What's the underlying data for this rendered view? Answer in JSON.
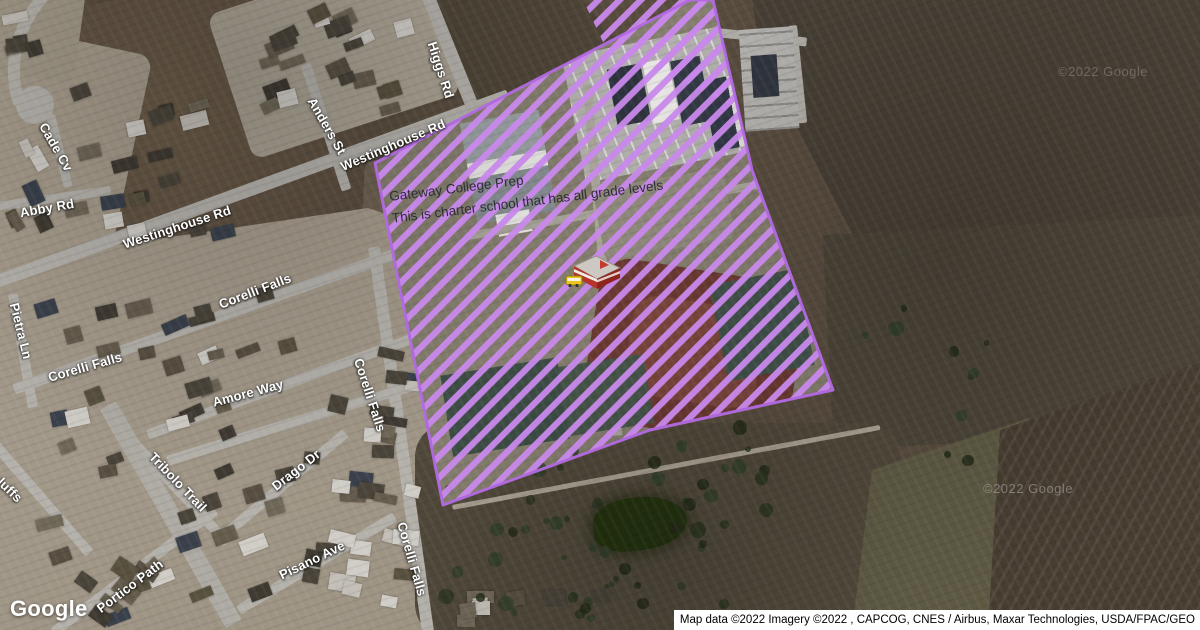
{
  "map": {
    "school_label": {
      "line1": "Gateway College Prep",
      "line2": "This is charter school that has all grade levels"
    },
    "streets": [
      {
        "text": "Higgs Rd"
      },
      {
        "text": "Anders St"
      },
      {
        "text": "Westinghouse Rd"
      },
      {
        "text": "Westinghouse Rd"
      },
      {
        "text": "Cade Cv"
      },
      {
        "text": "Abby Rd"
      },
      {
        "text": "Pietra Ln"
      },
      {
        "text": "Corelli Falls"
      },
      {
        "text": "Corelli Falls"
      },
      {
        "text": "Amore Way"
      },
      {
        "text": "Corelli Falls"
      },
      {
        "text": "Drago Dr"
      },
      {
        "text": "Tribolo Trail"
      },
      {
        "text": "Portico Path"
      },
      {
        "text": "Pisano Ave"
      },
      {
        "text": "Corelli Falls"
      },
      {
        "text": "luffs"
      }
    ],
    "watermark_top": "©2022 Google",
    "watermark_bottom": "©2022 Google",
    "google_logo": "Google",
    "attribution": "Map data ©2022 Imagery ©2022 , CAPCOG, CNES / Airbus, Maxar Technologies, USDA/FPAC/GEO",
    "overlay": {
      "stripe_color": "#c989ec",
      "border_color": "#b36ae2"
    }
  }
}
